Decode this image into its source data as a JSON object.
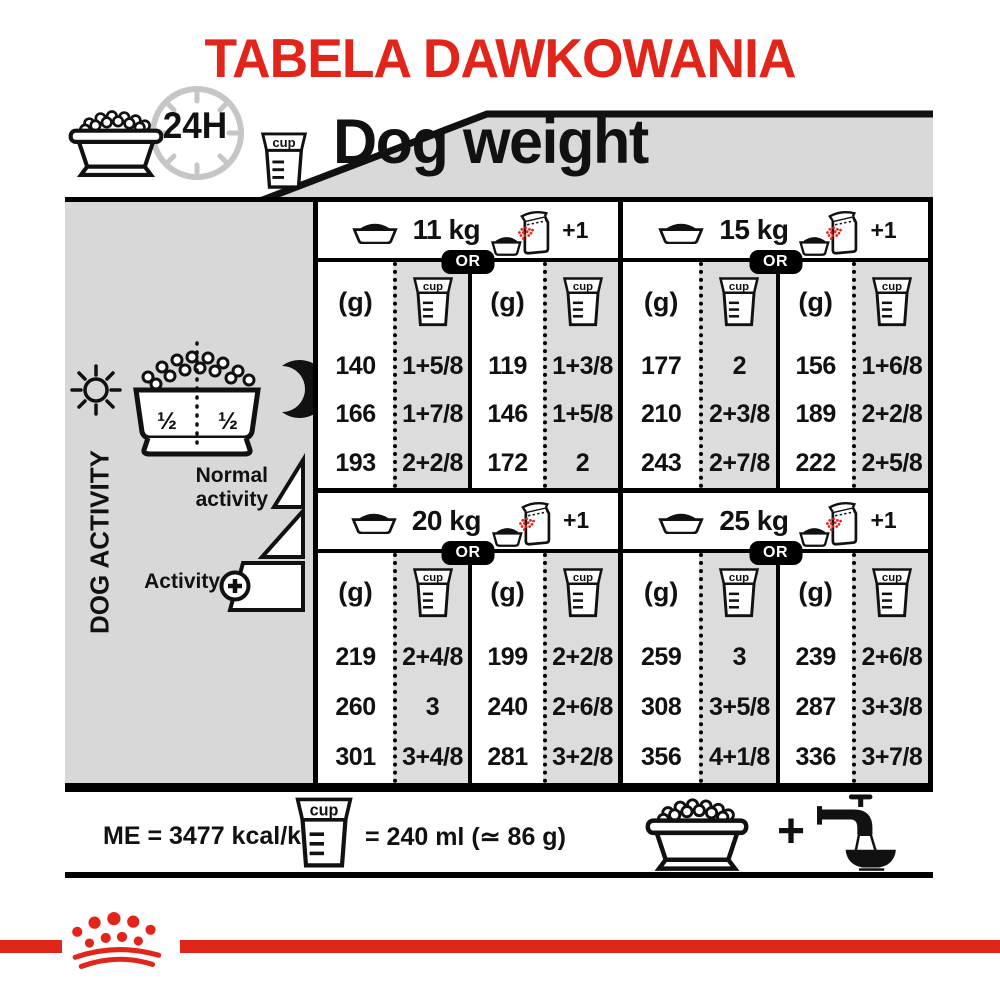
{
  "title": "TABELA DAWKOWANIA",
  "header": {
    "hours_label": "24H",
    "dog_weight_label": "Dog weight"
  },
  "labels": {
    "cup": "cup",
    "gram": "(g)",
    "or": "OR",
    "plus_one": "+1"
  },
  "sidebar": {
    "dog_activity": "DOG ACTIVITY",
    "half_left": "½",
    "half_right": "½",
    "normal_activity": "Normal activity",
    "activity": "Activity"
  },
  "table": {
    "sections": [
      {
        "weight": "11 kg",
        "rows": [
          [
            "140",
            "1+5/8",
            "119",
            "1+3/8"
          ],
          [
            "166",
            "1+7/8",
            "146",
            "1+5/8"
          ],
          [
            "193",
            "2+2/8",
            "172",
            "2"
          ]
        ]
      },
      {
        "weight": "15 kg",
        "rows": [
          [
            "177",
            "2",
            "156",
            "1+6/8"
          ],
          [
            "210",
            "2+3/8",
            "189",
            "2+2/8"
          ],
          [
            "243",
            "2+7/8",
            "222",
            "2+5/8"
          ]
        ]
      },
      {
        "weight": "20 kg",
        "rows": [
          [
            "219",
            "2+4/8",
            "199",
            "2+2/8"
          ],
          [
            "260",
            "3",
            "240",
            "2+6/8"
          ],
          [
            "301",
            "3+4/8",
            "281",
            "3+2/8"
          ]
        ]
      },
      {
        "weight": "25 kg",
        "rows": [
          [
            "259",
            "3",
            "239",
            "2+6/8"
          ],
          [
            "308",
            "3+5/8",
            "287",
            "3+3/8"
          ],
          [
            "356",
            "4+1/8",
            "336",
            "3+7/8"
          ]
        ]
      }
    ]
  },
  "footer": {
    "me": "ME = 3477 kcal/kg",
    "cup_equiv": "= 240 ml (≃ 86 g)",
    "plus": "+"
  },
  "colors": {
    "brand_red": "#e2251b",
    "panel_grey": "#d8d8d8",
    "cup_column_grey": "#dcdcdc",
    "border_black": "#000000"
  }
}
